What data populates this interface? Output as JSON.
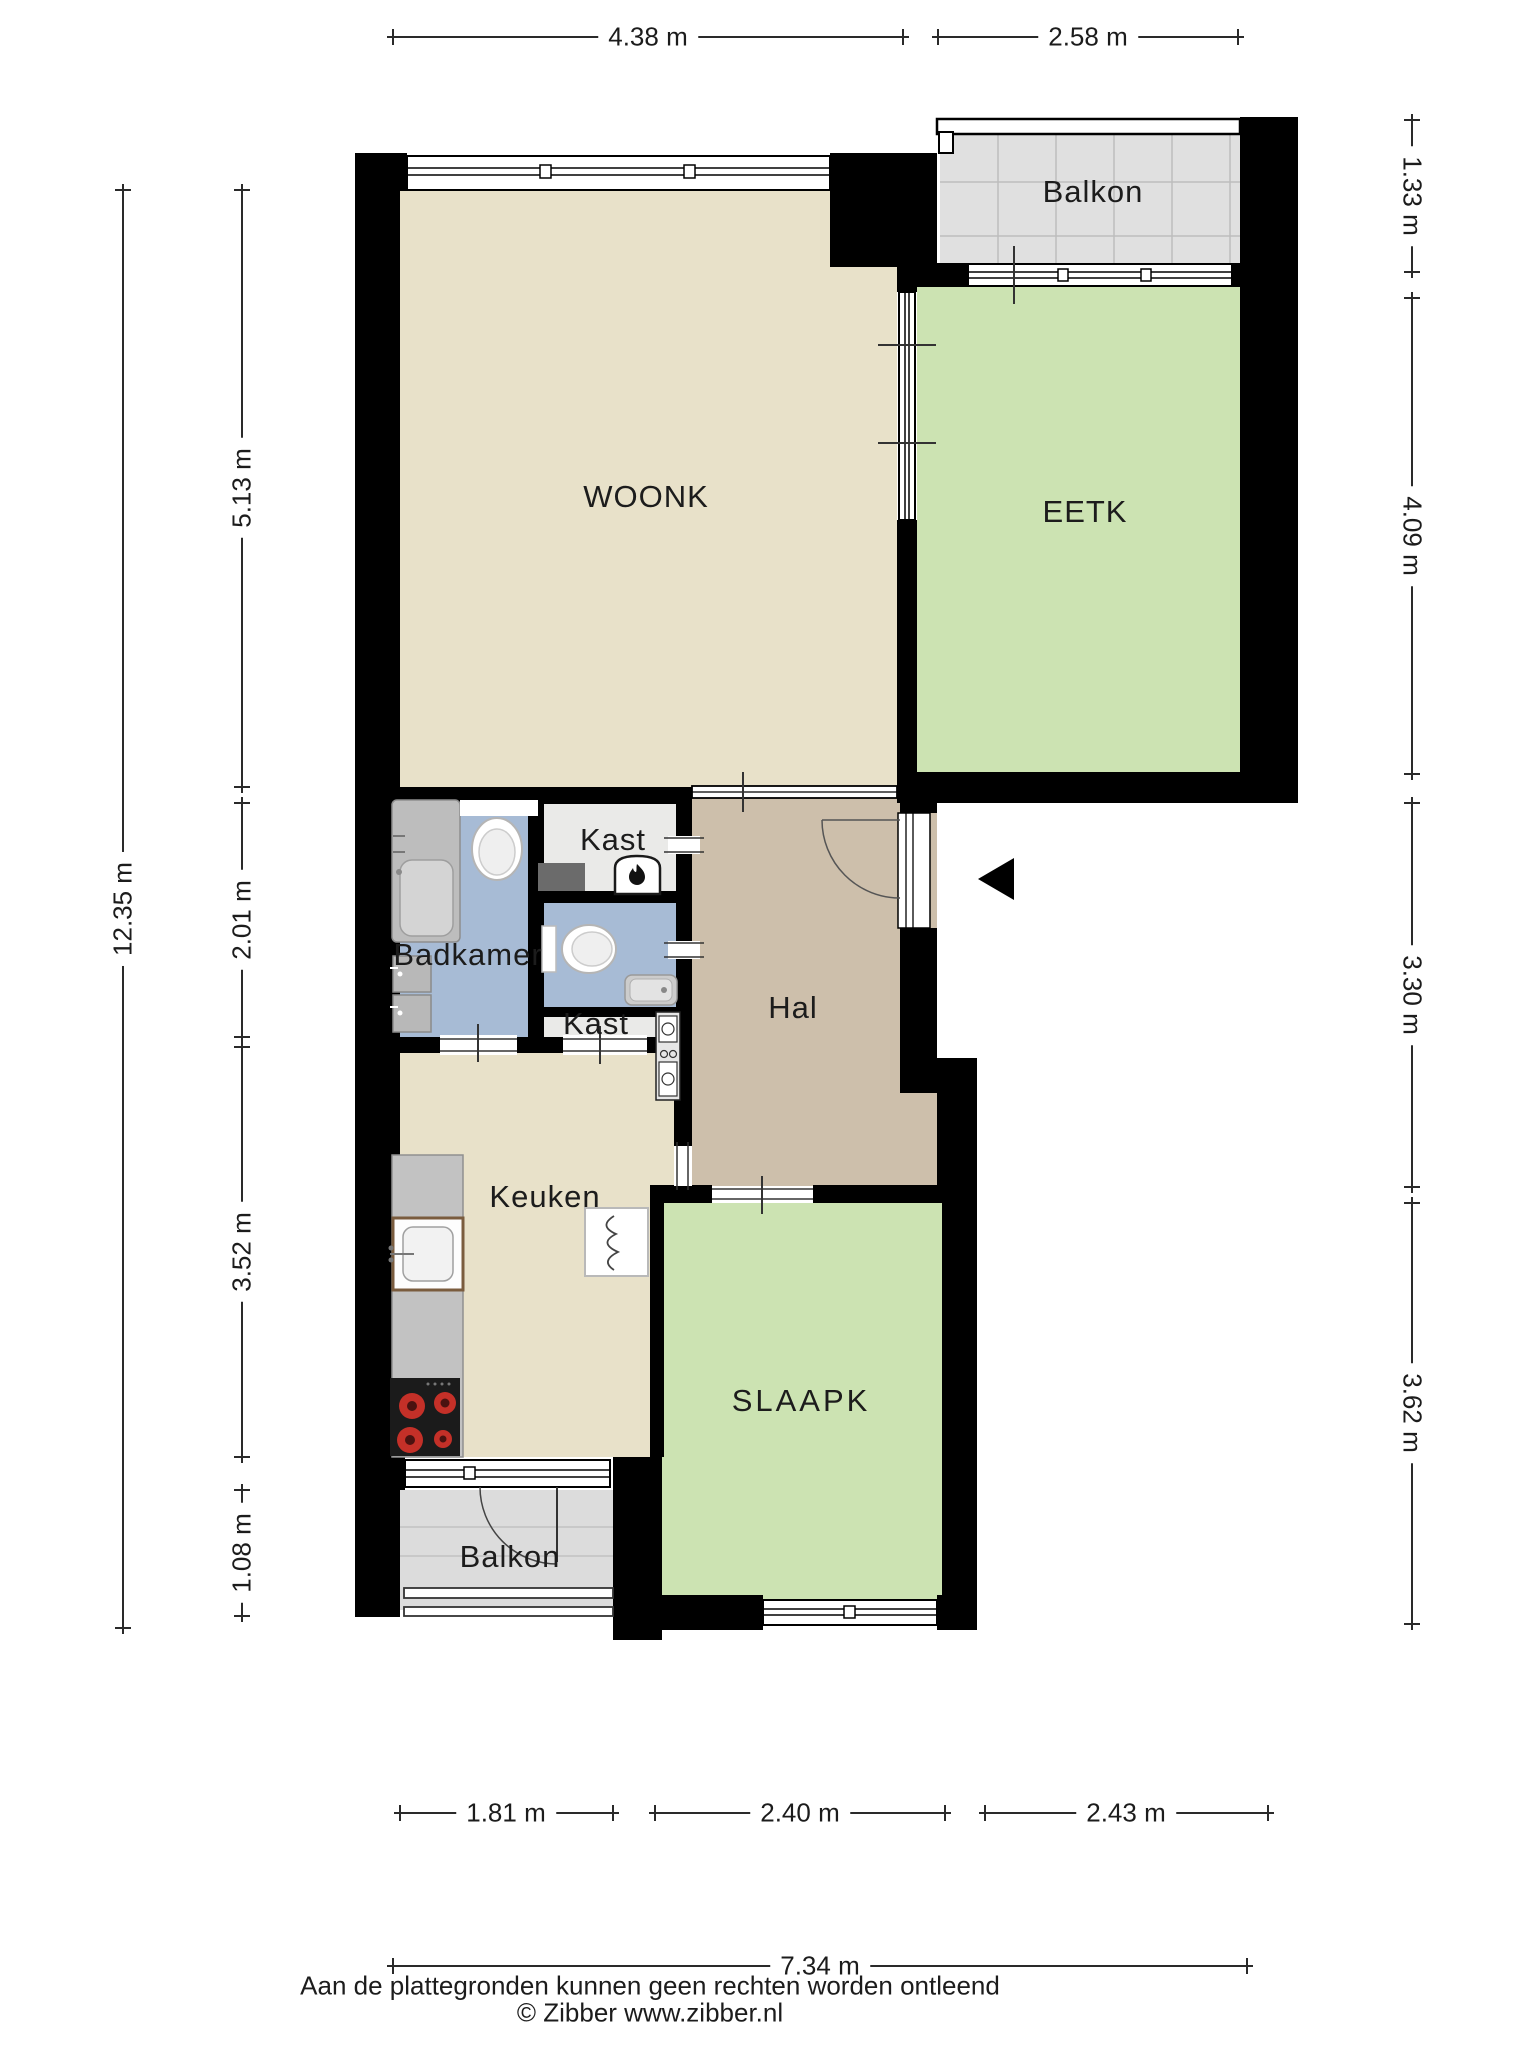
{
  "title": "Floor plan (plattegrond)",
  "rooms": {
    "woonk": {
      "label": "WOONK"
    },
    "eetk": {
      "label": "EETK"
    },
    "balkon_top": {
      "label": "Balkon"
    },
    "badkamer": {
      "label": "Badkamer"
    },
    "kast1": {
      "label": "Kast"
    },
    "kast2": {
      "label": "Kast"
    },
    "hal": {
      "label": "Hal"
    },
    "keuken": {
      "label": "Keuken"
    },
    "slaapk": {
      "label": "SLAAPK"
    },
    "balkon_bottom": {
      "label": "Balkon"
    }
  },
  "dimensions": {
    "top1": "4.38 m",
    "top2": "2.58 m",
    "right1": "1.33 m",
    "right2": "4.09 m",
    "right3": "3.30 m",
    "right4": "3.62 m",
    "left_total": "12.35 m",
    "left1": "5.13 m",
    "left2": "2.01 m",
    "left3": "3.52 m",
    "left4": "1.08 m",
    "bottom1": "1.81 m",
    "bottom2": "2.40 m",
    "bottom3": "2.43 m",
    "bottom_total": "7.34 m"
  },
  "footer": {
    "disclaimer": "Aan de plattegronden kunnen geen rechten worden ontleend",
    "copyright": "© Zibber www.zibber.nl"
  },
  "icons": {
    "entrance": "entrance-arrow",
    "boiler": "boiler-flame",
    "bathtub": "bathtub",
    "toilet_badkamer": "toilet",
    "toilet_wc": "toilet",
    "washbasins": "washbasin-cabinets",
    "wc_sink": "hand-basin",
    "kitchen_sink": "kitchen-sink",
    "cooktop": "cooktop-4-burners",
    "radiator": "radiator",
    "meter_cupboard": "meter-cupboard"
  },
  "colors": {
    "wall": "#000000",
    "woonk": "#e8e1c9",
    "eetk": "#cce3b2",
    "hal": "#cdbfab",
    "bad": "#a7bbd5",
    "kast": "#eaeae8",
    "balk": "#e0e0e0",
    "balk2": "#dcdcdc",
    "text": "#1c1c1c"
  }
}
